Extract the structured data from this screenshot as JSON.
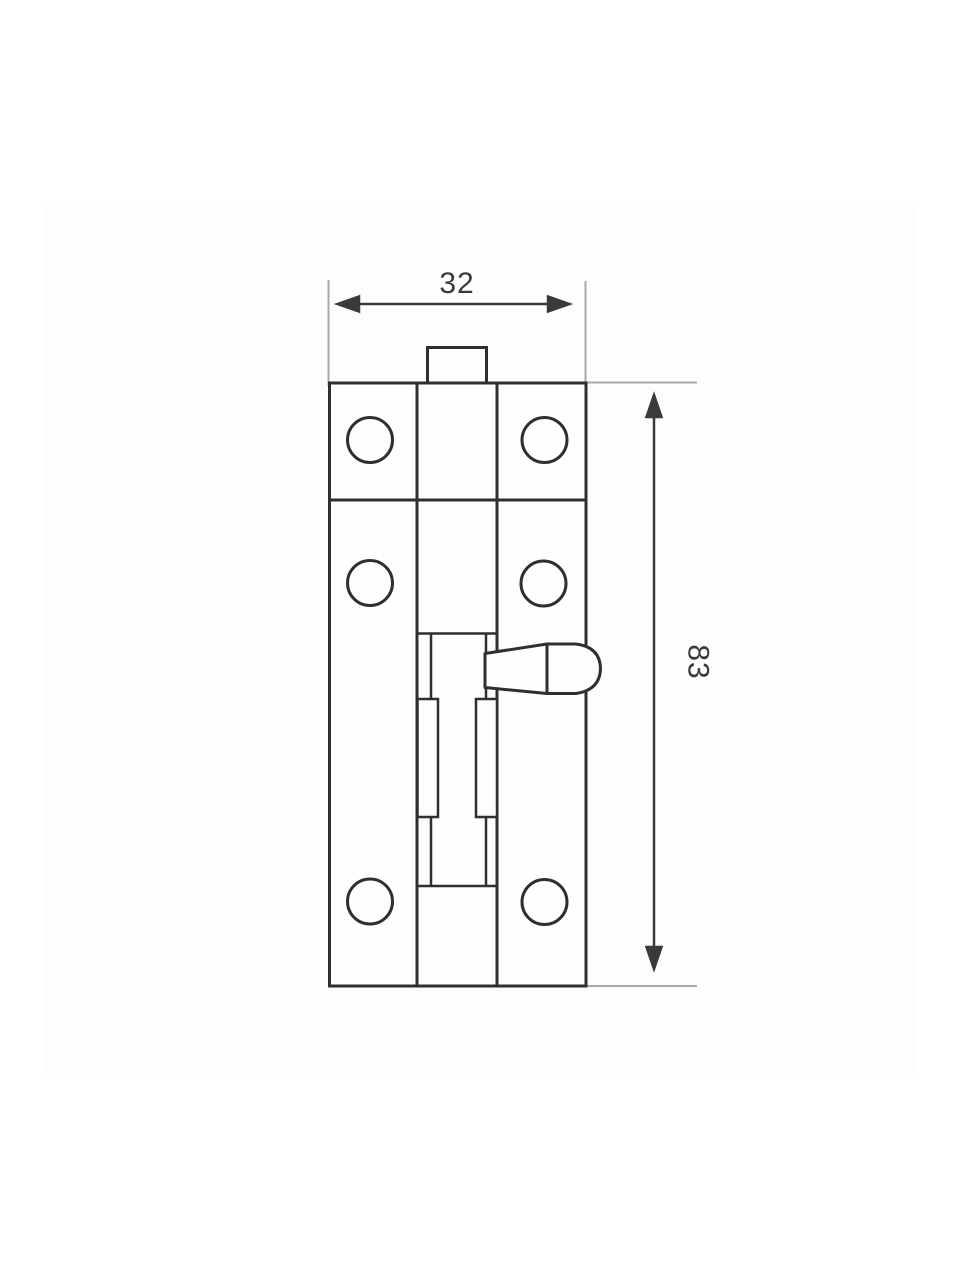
{
  "drawing": {
    "width_dim": "32",
    "height_dim": "83",
    "screw_hole_count": 6,
    "colors": {
      "line": "#2f2f2f",
      "dimension_text": "#3a3a3a",
      "extension": "#a9a9a9",
      "image_area": "#fdfdfd",
      "paper": "#ffffff"
    }
  }
}
